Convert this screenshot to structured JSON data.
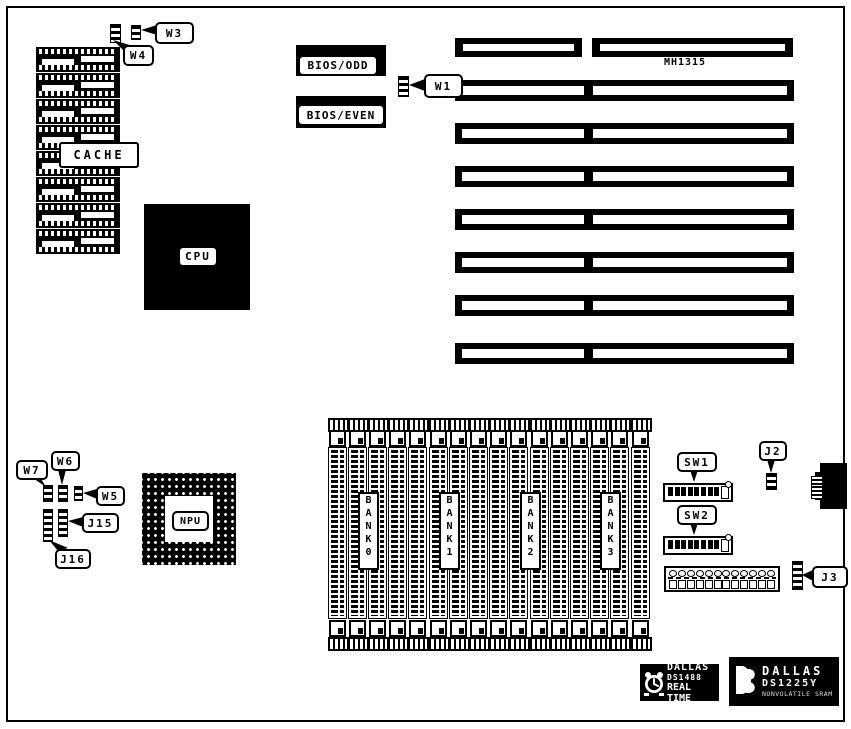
{
  "diagram": {
    "cache": {
      "label": "CACHE",
      "chip_rows": 8
    },
    "cpu": {
      "label": "CPU"
    },
    "npu": {
      "label": "NPU"
    },
    "bios_odd": {
      "label": "BIOS/ODD"
    },
    "bios_even": {
      "label": "BIOS/EVEN"
    },
    "expansion": {
      "label": "MH1315",
      "slot_rows": 8
    },
    "memory": {
      "socket_count": 16,
      "banks": [
        "BANK 0",
        "BANK 1",
        "BANK 2",
        "BANK 3"
      ]
    },
    "callouts": [
      {
        "id": "W3",
        "label": "W3"
      },
      {
        "id": "W4",
        "label": "W4"
      },
      {
        "id": "W1",
        "label": "W1"
      },
      {
        "id": "W7",
        "label": "W7"
      },
      {
        "id": "W6",
        "label": "W6"
      },
      {
        "id": "W5",
        "label": "W5"
      },
      {
        "id": "J15",
        "label": "J15"
      },
      {
        "id": "J16",
        "label": "J16"
      },
      {
        "id": "SW1",
        "label": "SW1"
      },
      {
        "id": "SW2",
        "label": "SW2"
      },
      {
        "id": "J2",
        "label": "J2"
      },
      {
        "id": "J3",
        "label": "J3"
      }
    ],
    "chips": {
      "rtc": {
        "brand": "DALLAS",
        "part": "DS1488",
        "line3": "REAL TIME"
      },
      "sram": {
        "brand": "DALLAS",
        "part": "DS1225Y",
        "line3": "NONVOLATILE SRAM"
      }
    },
    "colors": {
      "ink": "#000000",
      "paper": "#ffffff"
    }
  }
}
